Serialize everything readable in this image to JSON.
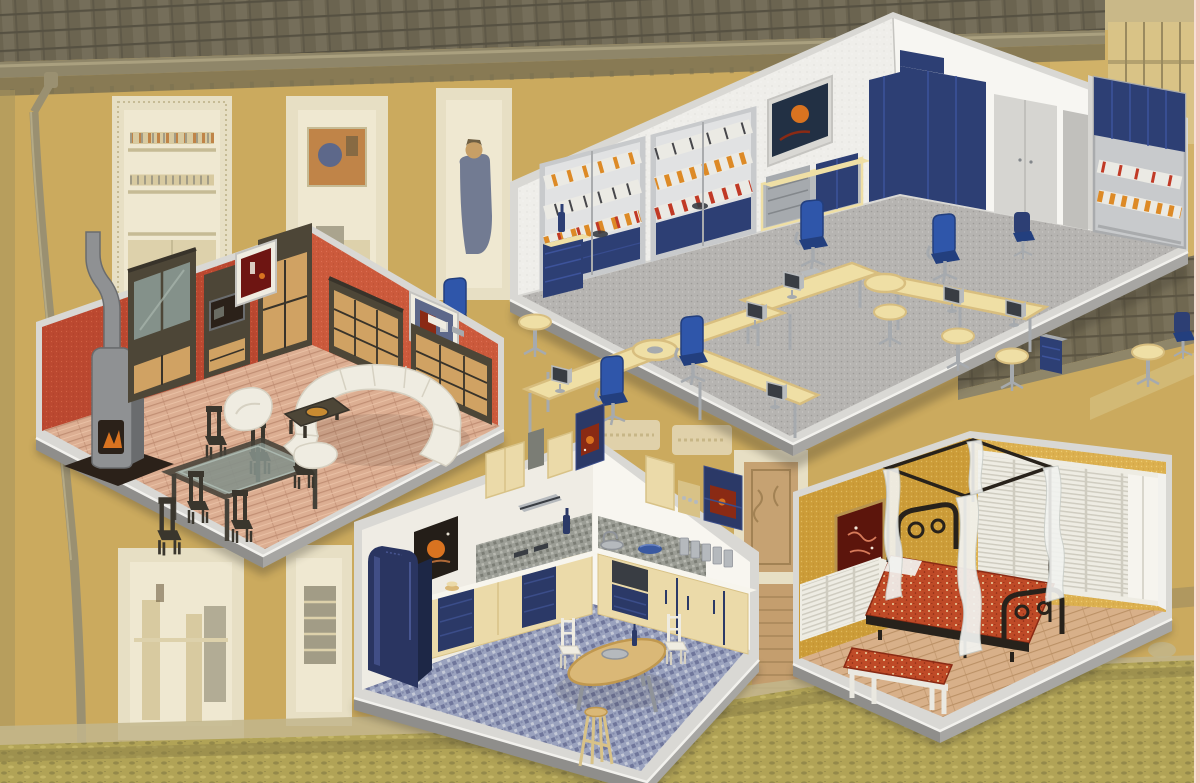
{
  "page": {
    "title": "Miniature furniture room dioramas collage"
  },
  "scene": {
    "kind": "product-photo-collage",
    "background": "faded yellow model house facade with tiled roof, ornate windows, downpipe and grass",
    "rooms": [
      {
        "id": "office",
        "label": "Office room diorama",
        "contents": [
          "binder shelf units",
          "blue cabinets",
          "wardrobes",
          "desk clusters",
          "blue office chairs",
          "monitors",
          "round side tables",
          "wall picture"
        ]
      },
      {
        "id": "living-room",
        "label": "Living room diorama",
        "contents": [
          "stove fireplace",
          "display cabinet",
          "tv cabinet",
          "sideboards",
          "white sectional sofa",
          "armchair",
          "ottoman",
          "glass dining table",
          "six chairs",
          "coffee table",
          "two wall pictures"
        ]
      },
      {
        "id": "kitchen",
        "label": "Kitchen diorama",
        "contents": [
          "blue refrigerator",
          "L-shaped counters",
          "upper cabinets",
          "range hood",
          "sink",
          "blue bowl",
          "canisters",
          "dining table",
          "white chairs",
          "bar stool",
          "wall poster"
        ]
      },
      {
        "id": "bedroom",
        "label": "Bedroom diorama",
        "contents": [
          "four poster canopy bed",
          "sheer curtains",
          "paisley bedding",
          "iron headboard",
          "louvered wardrobes",
          "louvered dresser",
          "bench",
          "wall picture"
        ]
      }
    ]
  },
  "palette": {
    "bgWall": "#cbaa5e",
    "bgWallHi": "#d8b972",
    "bgWallShade": "#a8935c",
    "bgRoof": "#6b6450",
    "bgRoofHi": "#7e7762",
    "bgRoofLine": "#565142",
    "bgGutter": "#8f8669",
    "bgGutterHi": "#aaa07f",
    "bgEave": "#7c7252",
    "bgFrame": "#e7dfc4",
    "bgFrameShade": "#c6bb95",
    "bgWin": "#efe8d1",
    "bgWinShade": "#ddd1ab",
    "bgPipe": "#9a9071",
    "bgPipeHi": "#b4aa86",
    "bgGrass": "#b1a356",
    "bgGrassDk": "#877d44",
    "bgGrassHi": "#c9ba6c",
    "bgBase": "#c2b68c",
    "bgBamboo": "#d9c489",
    "bgBeam": "#9a8a5f",
    "bgBrick": "#c49e6e",
    "bgBrickLine": "#a28254",
    "bgFig": "#67718c",
    "bgSkin": "#c79f66",
    "bgHair": "#6f5f42",
    "bgPicO": "#c08448",
    "bgPicB": "#5d688a",
    "bgInnerTan": "#d8caa0",
    "bgInnerGray": "#a29c86",
    "pinkEdge": "#f2c3ba",
    "pinkEdgeHi": "#f8ddd6",
    "white": "#f2f1ed",
    "trim": "#d9d8d4",
    "trimDk": "#c5c4c0",
    "plinth": "#a7a6a3",
    "plinthDk": "#8f8e8b",
    "shadow": "#2e2a22",
    "ofWallL": "#efeeea",
    "ofWallR": "#f7f6f2",
    "ofSpeck": "#dcdbd6",
    "ofCarpet": "#b6b4b1",
    "ofCarpetDk": "#9d9b98",
    "ofCarpetHi": "#c9c7c4",
    "shelf": "#c8cacc",
    "shelfDk": "#a9abad",
    "shelfBg": "#e1e2e3",
    "navy": "#2d3f74",
    "navyHi": "#3d539b",
    "bindW": "#ebeae4",
    "bindO": "#dd8a26",
    "bindR": "#c13a26",
    "bindD": "#47474b",
    "desk": "#efdfa5",
    "deskDk": "#d8be7f",
    "chrome": "#a6aaae",
    "chromeDk": "#83878b",
    "chairB": "#2f56aa",
    "chairBDk": "#233f7e",
    "mon": "#b8bbbd",
    "monDk": "#393d43",
    "ward": "#d6d5d1",
    "wardDk": "#c1c0bc",
    "picNavy": "#223044",
    "lvWallL": "#bb4830",
    "lvWallR": "#cc5a3c",
    "lvDotL": "#cf5f43",
    "lvDotLd": "#a83e28",
    "lvDotR": "#dd6f52",
    "lvDotRd": "#b34a30",
    "lvFloor": "#dcae92",
    "lvPlank": "#c18f74",
    "lvPlankHi": "#edc7ab",
    "brown": "#4d4637",
    "brownHi": "#605744",
    "brownDk": "#38332a",
    "tan": "#d0a263",
    "tanDk": "#b3854c",
    "glass": "#84918a",
    "glassHi": "#aab7ae",
    "sofa": "#efece1",
    "sofaDk": "#d6d1c2",
    "stove": "#8f9193",
    "stoveDk": "#6a6c6e",
    "flame": "#d97320",
    "fireDk": "#2b2119",
    "tableDk": "#454138",
    "chairDk": "#3a362d",
    "inlay": "#c98b31",
    "lvPic": "#6e1512",
    "ktWallL": "#efece4",
    "ktWallR": "#f8f6f0",
    "ktFloor": "#9aa2be",
    "ktFloorDk": "#646b92",
    "ktFloorHi": "#c9cdda",
    "cream": "#ebdaa9",
    "creamDk": "#d8c287",
    "ktNavy": "#2b3967",
    "ktNavyHi": "#3b4d89",
    "ctop": "#f7f5ed",
    "splash": "#9b9d95",
    "splashDk": "#7b7d75",
    "splashHi": "#b8b9b1",
    "steel": "#b5b9bd",
    "steelDk": "#8f9399",
    "wood": "#dab877",
    "woodDk": "#c0984f",
    "bowl": "#3a59a0",
    "fridge": "#2a3561",
    "fridgeHi": "#475590",
    "fridgeDk": "#1d2746",
    "artRed": "#8a2a14",
    "posterDk": "#241e18",
    "posterSw": "#b06a38",
    "bdWallL": "#cc9c38",
    "bdWallR": "#dcb04f",
    "bdDotL": "#e0b85c",
    "bdDotLd": "#b9882b",
    "bdDotR": "#eccb72",
    "bdDotRd": "#c49a3e",
    "bdFloor": "#d8b089",
    "bdPlank": "#bb9166",
    "shut": "#eeece3",
    "shutLn": "#cfccc0",
    "shutHi": "#f6f4ee",
    "iron": "#28221b",
    "duvet": "#bf4a27",
    "duvetDk": "#8a2a14",
    "duvetDot": "#ecd3a2",
    "curt": "#f2f3f0",
    "curtDk": "#c9cdc8",
    "bench": "#eae8e0",
    "bdPic": "#5c150c",
    "bdPicFr": "#b8934e"
  }
}
